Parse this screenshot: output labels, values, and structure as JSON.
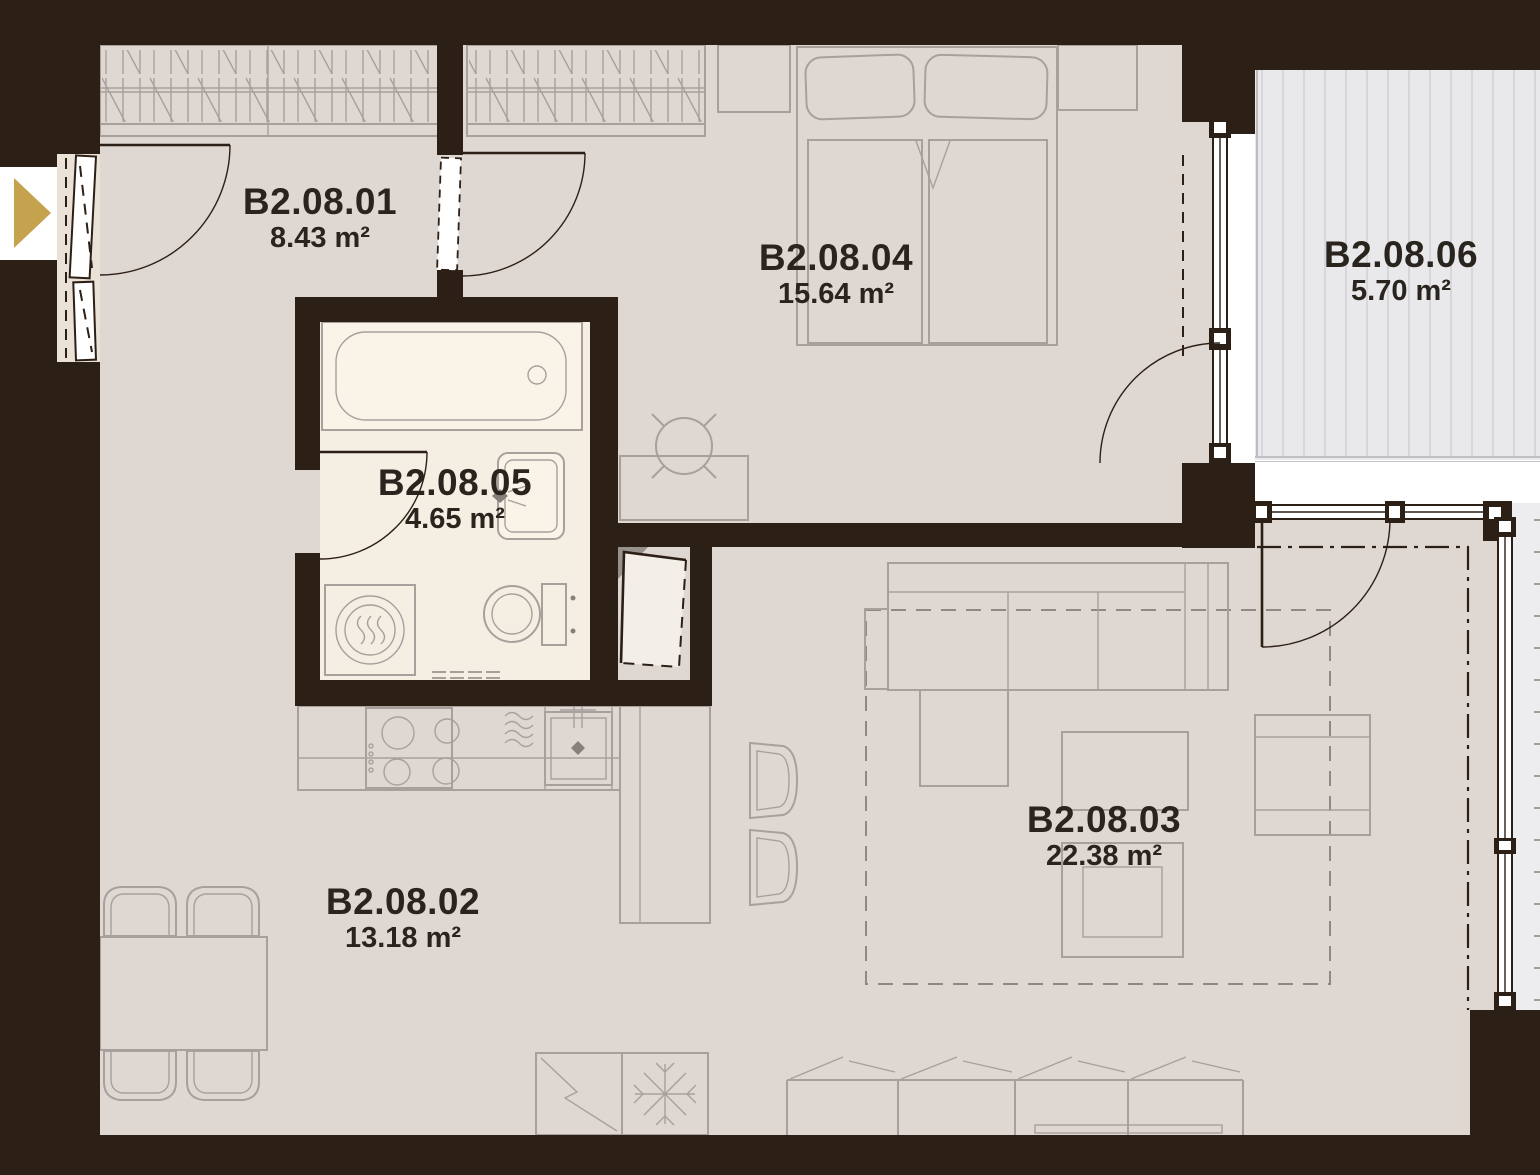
{
  "rooms": [
    {
      "id": "B2.08.01",
      "area": "8.43 m²"
    },
    {
      "id": "B2.08.02",
      "area": "13.18 m²"
    },
    {
      "id": "B2.08.03",
      "area": "22.38 m²"
    },
    {
      "id": "B2.08.04",
      "area": "15.64 m²"
    },
    {
      "id": "B2.08.05",
      "area": "4.65 m²"
    },
    {
      "id": "B2.08.06",
      "area": "5.70 m²"
    }
  ],
  "icons": {
    "entrance_arrow": "gold right-pointing triangle marking the apartment entrance"
  },
  "colors": {
    "wall": "#2C1F16",
    "floor": "#DED7D2",
    "bath_floor": "#F5EFE3",
    "fixture_fill": "#FAF4E8",
    "furniture_line": "#A8A09C",
    "rug_line": "#8F8884",
    "deck": "#E9E8EA",
    "deck_stripe": "#D7D6DA",
    "deck_edge": "#B2B1B6",
    "strip": "#EDECEF",
    "panel": "#EAE1D7",
    "arrow": "#C5A24E",
    "label": "#2A241E",
    "white": "#FFFFFF"
  }
}
